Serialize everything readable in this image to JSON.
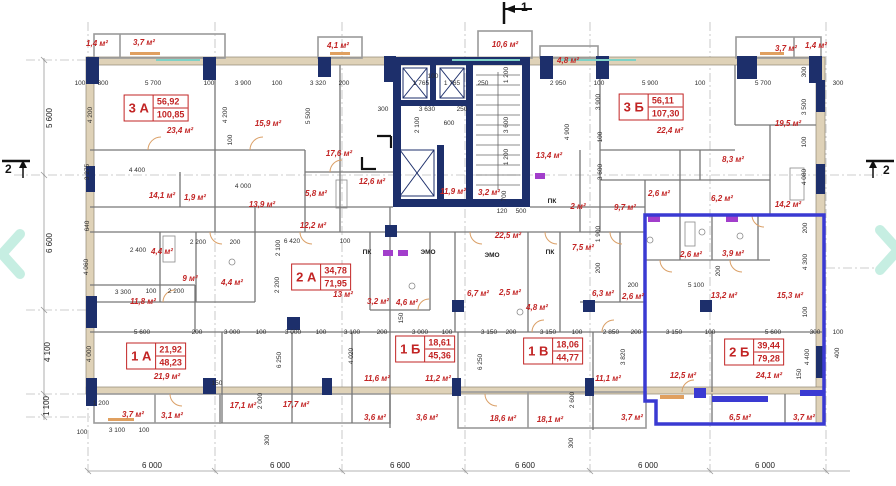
{
  "plan": {
    "markers": {
      "top": "1",
      "left": "2",
      "right": "2"
    },
    "colors": {
      "wall_navy": "#1d2f6b",
      "highlight_blue": "#3a3ad2",
      "label_red": "#c22424",
      "exterior_beige": "#dfd2b8",
      "nav_mint": "#c6eee2"
    },
    "nav": {
      "prev_icon": "chevron-left",
      "next_icon": "chevron-right"
    },
    "apartments": [
      {
        "label": "3 А",
        "v1": "56,92",
        "v2": "100,85",
        "x": 156,
        "y": 108
      },
      {
        "label": "3 Б",
        "v1": "56,11",
        "v2": "107,30",
        "x": 651,
        "y": 107
      },
      {
        "label": "2 А",
        "v1": "34,78",
        "v2": "71,95",
        "x": 321,
        "y": 277
      },
      {
        "label": "1 А",
        "v1": "21,92",
        "v2": "48,23",
        "x": 156,
        "y": 356
      },
      {
        "label": "1 Б",
        "v1": "18,61",
        "v2": "45,36",
        "x": 425,
        "y": 349
      },
      {
        "label": "1 В",
        "v1": "18,06",
        "v2": "44,77",
        "x": 553,
        "y": 351
      },
      {
        "label": "2 Б",
        "v1": "39,44",
        "v2": "79,28",
        "x": 754,
        "y": 352
      }
    ],
    "areas": [
      {
        "t": "1,4 м²",
        "x": 97,
        "y": 44
      },
      {
        "t": "3,7 м²",
        "x": 144,
        "y": 43
      },
      {
        "t": "4,1 м²",
        "x": 338,
        "y": 46
      },
      {
        "t": "10,6 м²",
        "x": 505,
        "y": 45
      },
      {
        "t": "4,8 м²",
        "x": 568,
        "y": 61
      },
      {
        "t": "3,7 м²",
        "x": 786,
        "y": 49
      },
      {
        "t": "1,4 м²",
        "x": 816,
        "y": 46
      },
      {
        "t": "23,4 м²",
        "x": 180,
        "y": 131
      },
      {
        "t": "15,9 м²",
        "x": 268,
        "y": 124
      },
      {
        "t": "17,6 м²",
        "x": 339,
        "y": 154
      },
      {
        "t": "19,5 м²",
        "x": 788,
        "y": 124
      },
      {
        "t": "22,4 м²",
        "x": 670,
        "y": 131
      },
      {
        "t": "8,3 м²",
        "x": 733,
        "y": 160
      },
      {
        "t": "13,4 м²",
        "x": 549,
        "y": 156
      },
      {
        "t": "12,6 м²",
        "x": 372,
        "y": 182
      },
      {
        "t": "11,9 м²",
        "x": 453,
        "y": 192
      },
      {
        "t": "3,2 м²",
        "x": 489,
        "y": 193
      },
      {
        "t": "14,1 м²",
        "x": 162,
        "y": 196
      },
      {
        "t": "1,9 м²",
        "x": 195,
        "y": 198
      },
      {
        "t": "13,9 м²",
        "x": 262,
        "y": 205
      },
      {
        "t": "5,8 м²",
        "x": 316,
        "y": 194
      },
      {
        "t": "2,6 м²",
        "x": 659,
        "y": 194
      },
      {
        "t": "9,7 м²",
        "x": 625,
        "y": 208
      },
      {
        "t": "2 м²",
        "x": 578,
        "y": 207
      },
      {
        "t": "6,2 м²",
        "x": 722,
        "y": 199
      },
      {
        "t": "14,2 м²",
        "x": 788,
        "y": 205
      },
      {
        "t": "12,2 м²",
        "x": 313,
        "y": 226
      },
      {
        "t": "22,5 м²",
        "x": 508,
        "y": 236
      },
      {
        "t": "7,5 м²",
        "x": 583,
        "y": 248
      },
      {
        "t": "2,6 м²",
        "x": 691,
        "y": 255
      },
      {
        "t": "3,9 м²",
        "x": 733,
        "y": 254
      },
      {
        "t": "4,4 м²",
        "x": 162,
        "y": 252
      },
      {
        "t": "2,6 м²",
        "x": 633,
        "y": 297
      },
      {
        "t": "6,3 м²",
        "x": 603,
        "y": 294
      },
      {
        "t": "13,2 м²",
        "x": 724,
        "y": 296
      },
      {
        "t": "15,3 м²",
        "x": 790,
        "y": 296
      },
      {
        "t": "9 м²",
        "x": 190,
        "y": 279
      },
      {
        "t": "4,4 м²",
        "x": 232,
        "y": 283
      },
      {
        "t": "13 м²",
        "x": 343,
        "y": 295
      },
      {
        "t": "11,8 м²",
        "x": 143,
        "y": 302
      },
      {
        "t": "3,2 м²",
        "x": 378,
        "y": 302
      },
      {
        "t": "4,6 м²",
        "x": 407,
        "y": 303
      },
      {
        "t": "6,7 м²",
        "x": 478,
        "y": 294
      },
      {
        "t": "2,5 м²",
        "x": 510,
        "y": 293
      },
      {
        "t": "4,8 м²",
        "x": 537,
        "y": 308
      },
      {
        "t": "21,9 м²",
        "x": 167,
        "y": 377
      },
      {
        "t": "12,5 м²",
        "x": 683,
        "y": 376
      },
      {
        "t": "24,1 м²",
        "x": 769,
        "y": 376
      },
      {
        "t": "11,6 м²",
        "x": 377,
        "y": 379
      },
      {
        "t": "11,2 м²",
        "x": 438,
        "y": 379
      },
      {
        "t": "11,1 м²",
        "x": 608,
        "y": 379
      },
      {
        "t": "17,1 м²",
        "x": 243,
        "y": 406
      },
      {
        "t": "17,7 м²",
        "x": 296,
        "y": 405
      },
      {
        "t": "3,7 м²",
        "x": 133,
        "y": 415
      },
      {
        "t": "3,1 м²",
        "x": 172,
        "y": 416
      },
      {
        "t": "3,6 м²",
        "x": 375,
        "y": 418
      },
      {
        "t": "3,6 м²",
        "x": 427,
        "y": 418
      },
      {
        "t": "18,6 м²",
        "x": 503,
        "y": 419
      },
      {
        "t": "18,1 м²",
        "x": 550,
        "y": 420
      },
      {
        "t": "3,7 м²",
        "x": 632,
        "y": 418
      },
      {
        "t": "6,5 м²",
        "x": 740,
        "y": 418
      },
      {
        "t": "3,7 м²",
        "x": 804,
        "y": 418
      }
    ],
    "notes": [
      {
        "t": "ПК",
        "x": 367,
        "y": 253
      },
      {
        "t": "ПК",
        "x": 550,
        "y": 253
      },
      {
        "t": "ПК",
        "x": 552,
        "y": 202
      },
      {
        "t": "ЭМО",
        "x": 428,
        "y": 253
      },
      {
        "t": "ЭМО",
        "x": 492,
        "y": 256
      }
    ],
    "dims_h": [
      {
        "t": "100",
        "x": 80,
        "y": 84
      },
      {
        "t": "300",
        "x": 103,
        "y": 84
      },
      {
        "t": "5 700",
        "x": 153,
        "y": 84
      },
      {
        "t": "100",
        "x": 209,
        "y": 84
      },
      {
        "t": "3 900",
        "x": 243,
        "y": 84
      },
      {
        "t": "100",
        "x": 277,
        "y": 84
      },
      {
        "t": "3 320",
        "x": 318,
        "y": 84
      },
      {
        "t": "200",
        "x": 344,
        "y": 84
      },
      {
        "t": "100",
        "x": 433,
        "y": 77
      },
      {
        "t": "1 765",
        "x": 421,
        "y": 84
      },
      {
        "t": "1 765",
        "x": 452,
        "y": 84
      },
      {
        "t": "250",
        "x": 483,
        "y": 84
      },
      {
        "t": "2 950",
        "x": 558,
        "y": 84
      },
      {
        "t": "100",
        "x": 599,
        "y": 84
      },
      {
        "t": "5 900",
        "x": 650,
        "y": 84
      },
      {
        "t": "100",
        "x": 700,
        "y": 84
      },
      {
        "t": "5 700",
        "x": 763,
        "y": 84
      },
      {
        "t": "300",
        "x": 838,
        "y": 84
      },
      {
        "t": "300",
        "x": 383,
        "y": 110
      },
      {
        "t": "3 630",
        "x": 427,
        "y": 110
      },
      {
        "t": "250",
        "x": 462,
        "y": 110
      },
      {
        "t": "600",
        "x": 449,
        "y": 124
      },
      {
        "t": "120",
        "x": 502,
        "y": 212
      },
      {
        "t": "500",
        "x": 521,
        "y": 212
      },
      {
        "t": "4 400",
        "x": 137,
        "y": 171
      },
      {
        "t": "4 000",
        "x": 243,
        "y": 187
      },
      {
        "t": "2 200",
        "x": 198,
        "y": 243
      },
      {
        "t": "200",
        "x": 235,
        "y": 243
      },
      {
        "t": "6 420",
        "x": 292,
        "y": 242
      },
      {
        "t": "100",
        "x": 345,
        "y": 242
      },
      {
        "t": "2 400",
        "x": 138,
        "y": 251
      },
      {
        "t": "200",
        "x": 633,
        "y": 286
      },
      {
        "t": "5 100",
        "x": 696,
        "y": 286
      },
      {
        "t": "3 300",
        "x": 123,
        "y": 293
      },
      {
        "t": "100",
        "x": 151,
        "y": 292
      },
      {
        "t": "2 200",
        "x": 176,
        "y": 292
      },
      {
        "t": "5 600",
        "x": 142,
        "y": 333
      },
      {
        "t": "200",
        "x": 197,
        "y": 333
      },
      {
        "t": "3 000",
        "x": 232,
        "y": 333
      },
      {
        "t": "100",
        "x": 261,
        "y": 333
      },
      {
        "t": "3 000",
        "x": 293,
        "y": 333
      },
      {
        "t": "100",
        "x": 321,
        "y": 333
      },
      {
        "t": "3 100",
        "x": 352,
        "y": 333
      },
      {
        "t": "200",
        "x": 382,
        "y": 333
      },
      {
        "t": "3 000",
        "x": 420,
        "y": 333
      },
      {
        "t": "100",
        "x": 447,
        "y": 333
      },
      {
        "t": "3 150",
        "x": 489,
        "y": 333
      },
      {
        "t": "200",
        "x": 511,
        "y": 333
      },
      {
        "t": "3 150",
        "x": 548,
        "y": 333
      },
      {
        "t": "100",
        "x": 577,
        "y": 333
      },
      {
        "t": "2 850",
        "x": 611,
        "y": 333
      },
      {
        "t": "200",
        "x": 636,
        "y": 333
      },
      {
        "t": "3 150",
        "x": 674,
        "y": 333
      },
      {
        "t": "100",
        "x": 710,
        "y": 333
      },
      {
        "t": "5 600",
        "x": 773,
        "y": 333
      },
      {
        "t": "300",
        "x": 815,
        "y": 333
      },
      {
        "t": "100",
        "x": 838,
        "y": 333
      },
      {
        "t": "150",
        "x": 217,
        "y": 384
      },
      {
        "t": "1 200",
        "x": 101,
        "y": 404
      },
      {
        "t": "100",
        "x": 82,
        "y": 433
      },
      {
        "t": "3 100",
        "x": 117,
        "y": 431
      },
      {
        "t": "100",
        "x": 144,
        "y": 431
      }
    ],
    "dims_v": [
      {
        "t": "4 200",
        "x": 91,
        "y": 115
      },
      {
        "t": "4 200",
        "x": 226,
        "y": 115
      },
      {
        "t": "5 500",
        "x": 309,
        "y": 116
      },
      {
        "t": "100",
        "x": 231,
        "y": 140
      },
      {
        "t": "3 900",
        "x": 599,
        "y": 102
      },
      {
        "t": "100",
        "x": 601,
        "y": 137
      },
      {
        "t": "3 600",
        "x": 601,
        "y": 172
      },
      {
        "t": "3 275",
        "x": 88,
        "y": 172
      },
      {
        "t": "1 200",
        "x": 507,
        "y": 75
      },
      {
        "t": "2 100",
        "x": 418,
        "y": 125
      },
      {
        "t": "3 600",
        "x": 507,
        "y": 125
      },
      {
        "t": "1 200",
        "x": 507,
        "y": 157
      },
      {
        "t": "4 900",
        "x": 568,
        "y": 132
      },
      {
        "t": "700",
        "x": 505,
        "y": 196
      },
      {
        "t": "640",
        "x": 88,
        "y": 226
      },
      {
        "t": "4 060",
        "x": 87,
        "y": 267
      },
      {
        "t": "2 100",
        "x": 279,
        "y": 248
      },
      {
        "t": "2 200",
        "x": 278,
        "y": 285
      },
      {
        "t": "1 900",
        "x": 599,
        "y": 234
      },
      {
        "t": "200",
        "x": 599,
        "y": 268
      },
      {
        "t": "200",
        "x": 719,
        "y": 271
      },
      {
        "t": "300",
        "x": 805,
        "y": 72
      },
      {
        "t": "3 500",
        "x": 805,
        "y": 107
      },
      {
        "t": "100",
        "x": 805,
        "y": 142
      },
      {
        "t": "4 080",
        "x": 805,
        "y": 177
      },
      {
        "t": "200",
        "x": 806,
        "y": 228
      },
      {
        "t": "4 300",
        "x": 806,
        "y": 262
      },
      {
        "t": "100",
        "x": 806,
        "y": 312
      },
      {
        "t": "4 400",
        "x": 808,
        "y": 357
      },
      {
        "t": "150",
        "x": 800,
        "y": 374
      },
      {
        "t": "400",
        "x": 838,
        "y": 353
      },
      {
        "t": "4 000",
        "x": 90,
        "y": 354
      },
      {
        "t": "150",
        "x": 402,
        "y": 318
      },
      {
        "t": "6 250",
        "x": 280,
        "y": 360
      },
      {
        "t": "6 250",
        "x": 481,
        "y": 362
      },
      {
        "t": "4 020",
        "x": 352,
        "y": 356
      },
      {
        "t": "3 820",
        "x": 624,
        "y": 357
      },
      {
        "t": "2 000",
        "x": 261,
        "y": 401
      },
      {
        "t": "2 600",
        "x": 573,
        "y": 400
      },
      {
        "t": "300",
        "x": 268,
        "y": 440
      },
      {
        "t": "300",
        "x": 572,
        "y": 443
      }
    ],
    "axis_bottom": [
      {
        "t": "6 000",
        "x": 152,
        "y": 466
      },
      {
        "t": "6 000",
        "x": 280,
        "y": 466
      },
      {
        "t": "6 600",
        "x": 400,
        "y": 466
      },
      {
        "t": "6 600",
        "x": 525,
        "y": 466
      },
      {
        "t": "6 000",
        "x": 648,
        "y": 466
      },
      {
        "t": "6 000",
        "x": 765,
        "y": 466
      }
    ],
    "axis_left": [
      {
        "t": "5 600",
        "x": 50,
        "y": 118
      },
      {
        "t": "6 600",
        "x": 50,
        "y": 243
      },
      {
        "t": "4 100",
        "x": 48,
        "y": 352
      },
      {
        "t": "1 100",
        "x": 47,
        "y": 406
      }
    ]
  }
}
